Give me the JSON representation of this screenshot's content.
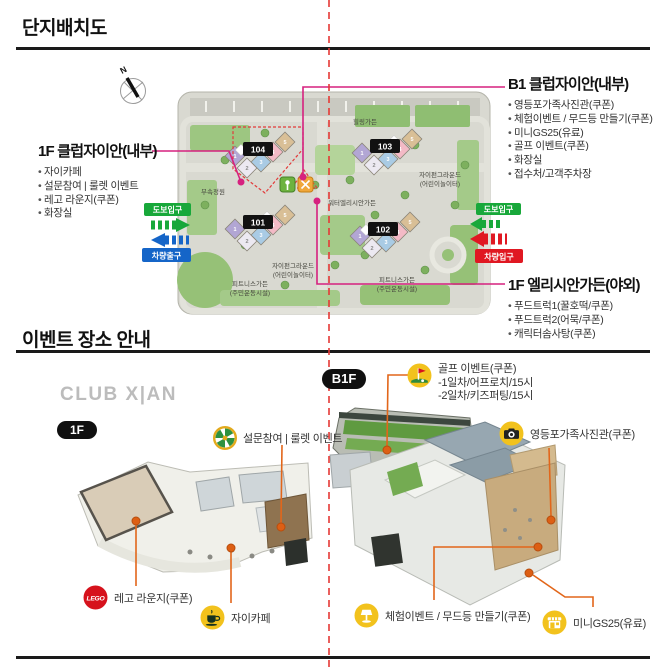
{
  "sections": {
    "site_plan_title": "단지배치도",
    "event_guide_title": "이벤트 장소 안내"
  },
  "compass": {
    "north": "N"
  },
  "site_plan": {
    "buildings": [
      {
        "id": "104"
      },
      {
        "id": "103"
      },
      {
        "id": "101"
      },
      {
        "id": "102"
      }
    ],
    "unit_numbers": [
      "1",
      "2",
      "3",
      "4",
      "5"
    ],
    "map_labels": {
      "healing_garden": "힐링가든",
      "fun_ground_right": "자이펀그라운드",
      "fun_ground_right_sub": "(어린이놀이터)",
      "fun_ground_bottom": "자이펀그라운드",
      "fun_ground_bottom_sub": "(어린이놀이터)",
      "annex_garden": "부속정원",
      "water_garden": "워터엘리시안가든",
      "fitness_left": "피트니스가든",
      "fitness_left_sub": "(주민운동시설)",
      "fitness_right": "피트니스가든",
      "fitness_right_sub": "(주민운동시설)"
    },
    "entrances": {
      "left_walk": "도보입구",
      "left_car_exit": "차량출구",
      "right_walk": "도보입구",
      "right_car_entry": "차량입구"
    },
    "callouts": [
      {
        "title": "1F 클럽자이안(내부)",
        "items": [
          "자이카페",
          "설문참여 | 룰렛 이벤트",
          "레고 라운지(쿠폰)",
          "화장실"
        ]
      },
      {
        "title": "B1 클럽자이안(내부)",
        "items": [
          "영등포가족사진관(쿠폰)",
          "체험이벤트 / 무드등 만들기(쿠폰)",
          "미니GS25(유료)",
          "골프 이벤트(쿠폰)",
          "화장실",
          "접수처/고객주차장"
        ]
      },
      {
        "title": "1F 엘리시안가든(야외)",
        "items": [
          "푸드트럭1(꿀호떡/쿠폰)",
          "푸드트럭2(어묵/쿠폰)",
          "캐릭터솜사탕(쿠폰)"
        ]
      }
    ]
  },
  "event_guide": {
    "club_name": "CLUB X|AN",
    "floor_1f": {
      "badge": "1F",
      "roulette": "설문참여 | 룰렛 이벤트",
      "lego": "레고 라운지(쿠폰)",
      "cafe": "자이카페"
    },
    "floor_b1f": {
      "badge": "B1F",
      "golf": "골프 이벤트(쿠폰)",
      "golf_detail_1": "-1일차/어프로치/15시",
      "golf_detail_2": "-2일차/키즈퍼팅/15시",
      "photo": "영등포가족사진관(쿠폰)",
      "lamp": "체험이벤트 / 무드등 만들기(쿠폰)",
      "store": "미니GS25(유료)"
    }
  },
  "colors": {
    "magenta_callout": "#d6217f",
    "orange_callout": "#e2661a",
    "fold_line_red": "#e53935",
    "walk_green": "#18a83a",
    "car_blue": "#1565c8",
    "car_red": "#e01822",
    "icon_yellow": "#f2c21d",
    "lego_red": "#d6121c"
  }
}
